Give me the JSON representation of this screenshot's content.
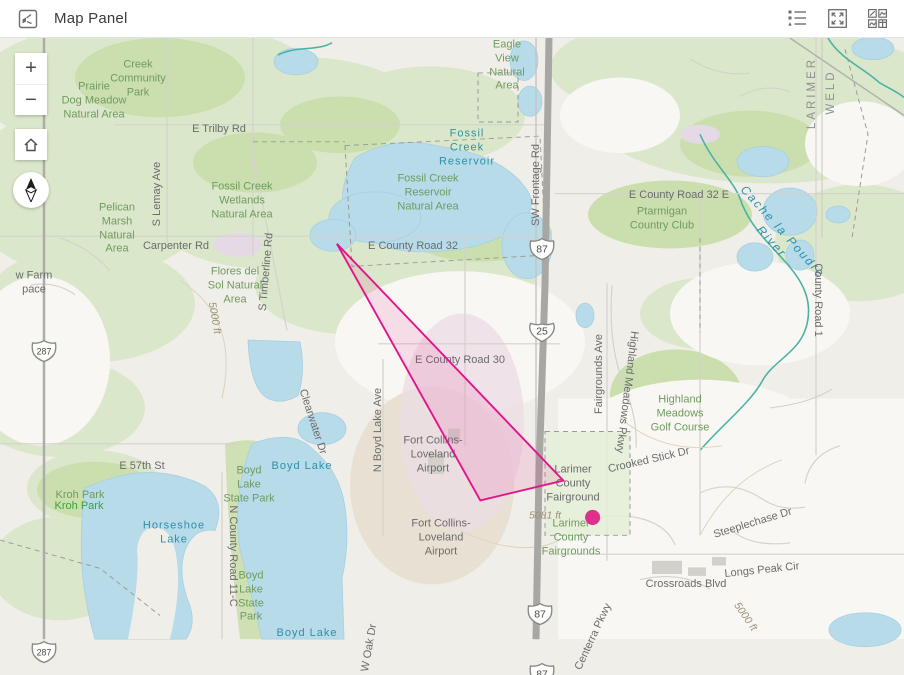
{
  "header": {
    "title": "Map Panel",
    "buttons": {
      "legend": "legend",
      "expand": "expand",
      "overview": "widget-overview"
    }
  },
  "controls": {
    "zoom_in": "+",
    "zoom_out": "−",
    "home": "home",
    "compass": "north"
  },
  "map": {
    "overlay": {
      "polygon_points": "330,256 570,507 482,528",
      "stroke": "#e2148c",
      "fill": "rgba(228,22,140,0.12)",
      "dot": {
        "x": 601,
        "y": 546,
        "r": 8,
        "color": "#dd2f8b"
      }
    },
    "shields": [
      {
        "type": "us",
        "text": "287",
        "x": 43,
        "y": 350
      },
      {
        "type": "us",
        "text": "287",
        "x": 43,
        "y": 651
      },
      {
        "type": "us",
        "text": "87",
        "x": 541,
        "y": 248
      },
      {
        "type": "interstate",
        "text": "25",
        "x": 541,
        "y": 330
      },
      {
        "type": "us",
        "text": "87",
        "x": 539,
        "y": 613
      },
      {
        "type": "us",
        "text": "87",
        "x": 541,
        "y": 673
      }
    ],
    "labels": [
      {
        "t": "Creek\nCommunity\nPark",
        "x": 138,
        "y": 79,
        "s": "green"
      },
      {
        "t": "Prairie\nDog Meadow\nNatural Area",
        "x": 94,
        "y": 101,
        "s": "green"
      },
      {
        "t": "E Trilby Rd",
        "x": 219,
        "y": 130,
        "s": "road"
      },
      {
        "t": "Eagle\nView\nNatural\nArea",
        "x": 507,
        "y": 66,
        "s": "green"
      },
      {
        "t": "Fossil\nCreek\nReservoir",
        "x": 467,
        "y": 148,
        "s": "water"
      },
      {
        "t": "Fossil Creek\nWetlands\nNatural Area",
        "x": 242,
        "y": 201,
        "s": "green"
      },
      {
        "t": "Fossil Creek\nReservoir\nNatural Area",
        "x": 428,
        "y": 193,
        "s": "green"
      },
      {
        "t": "SW Frontage Rd",
        "x": 537,
        "y": 185,
        "r": -90,
        "s": "road"
      },
      {
        "t": "E County Road 32 E",
        "x": 679,
        "y": 196,
        "s": "road"
      },
      {
        "t": "Ptarmigan\nCountry Club",
        "x": 662,
        "y": 219,
        "s": "green"
      },
      {
        "t": "Cache la Poudre River",
        "x": 777,
        "y": 237,
        "r": 48,
        "s": "witalic"
      },
      {
        "t": "County Road 1",
        "x": 817,
        "y": 300,
        "r": 90,
        "s": "road"
      },
      {
        "t": "LARIMER",
        "x": 812,
        "y": 93,
        "r": -90,
        "s": "county"
      },
      {
        "t": "WELD",
        "x": 831,
        "y": 92,
        "r": -90,
        "s": "county"
      },
      {
        "t": "Pelican\nMarsh\nNatural\nArea",
        "x": 117,
        "y": 229,
        "s": "green"
      },
      {
        "t": "S Lemay Ave",
        "x": 158,
        "y": 194,
        "r": -90,
        "s": "road"
      },
      {
        "t": "Carpenter Rd",
        "x": 176,
        "y": 247,
        "s": "road"
      },
      {
        "t": "Flores del\nSol Natural\nArea",
        "x": 235,
        "y": 286,
        "s": "green"
      },
      {
        "t": "S Timberline Rd",
        "x": 267,
        "y": 272,
        "r": -85,
        "s": "road"
      },
      {
        "t": "w Farm\npace",
        "x": 34,
        "y": 283,
        "s": "road"
      },
      {
        "t": "E County Road 32",
        "x": 413,
        "y": 247,
        "s": "road"
      },
      {
        "t": "E County Road 30",
        "x": 460,
        "y": 361,
        "s": "road"
      },
      {
        "t": "Fairgrounds Ave",
        "x": 600,
        "y": 374,
        "r": -90,
        "s": "road"
      },
      {
        "t": "Highland Meadows Pkwy",
        "x": 626,
        "y": 392,
        "r": 97,
        "s": "road"
      },
      {
        "t": "Highland\nMeadows\nGolf Course",
        "x": 680,
        "y": 414,
        "s": "green"
      },
      {
        "t": "Crooked Stick Dr",
        "x": 649,
        "y": 461,
        "r": -13,
        "s": "road"
      },
      {
        "t": "N Boyd Lake Ave",
        "x": 379,
        "y": 430,
        "r": -90,
        "s": "road"
      },
      {
        "t": "Clearwater Dr",
        "x": 312,
        "y": 422,
        "r": 72,
        "s": "road"
      },
      {
        "t": "Fort Collins-\nLoveland\nAirport",
        "x": 433,
        "y": 455,
        "s": "road"
      },
      {
        "t": "Fort Collins-\nLoveland\nAirport",
        "x": 441,
        "y": 538,
        "s": "road"
      },
      {
        "t": "Larimer\nCounty\nFairground",
        "x": 573,
        "y": 484,
        "s": "road"
      },
      {
        "t": "5081 ft",
        "x": 545,
        "y": 516,
        "s": "contour"
      },
      {
        "t": "Larimer\nCounty\nFairgrounds",
        "x": 571,
        "y": 538,
        "s": "green"
      },
      {
        "t": "Steeplechase Dr",
        "x": 753,
        "y": 524,
        "r": -17,
        "s": "road"
      },
      {
        "t": "Longs Peak Cir",
        "x": 762,
        "y": 571,
        "r": -6,
        "s": "road"
      },
      {
        "t": "Crossroads Blvd",
        "x": 686,
        "y": 585,
        "s": "road"
      },
      {
        "t": "Centerra Pkwy",
        "x": 594,
        "y": 637,
        "r": -65,
        "s": "road"
      },
      {
        "t": "E 57th St",
        "x": 142,
        "y": 467,
        "s": "road"
      },
      {
        "t": "Kroh Park",
        "x": 80,
        "y": 496,
        "s": "green"
      },
      {
        "t": "Kroh Park",
        "x": 79,
        "y": 507,
        "s": "bright"
      },
      {
        "t": "Boyd\nLake\nState Park",
        "x": 249,
        "y": 485,
        "s": "green"
      },
      {
        "t": "Boyd Lake",
        "x": 302,
        "y": 467,
        "s": "water"
      },
      {
        "t": "Horseshoe\nLake",
        "x": 174,
        "y": 533,
        "s": "water"
      },
      {
        "t": "N County Road 11-C",
        "x": 232,
        "y": 556,
        "r": 90,
        "s": "road"
      },
      {
        "t": "Boyd\nLake\nState\nPark",
        "x": 251,
        "y": 597,
        "s": "green"
      },
      {
        "t": "Boyd Lake",
        "x": 307,
        "y": 634,
        "s": "water"
      },
      {
        "t": "W Oak Dr",
        "x": 370,
        "y": 648,
        "r": -80,
        "s": "road"
      },
      {
        "t": "5000 ft",
        "x": 214,
        "y": 318,
        "r": 80,
        "s": "contour"
      },
      {
        "t": "5000 ft",
        "x": 745,
        "y": 617,
        "r": 55,
        "s": "contour"
      }
    ],
    "palette": {
      "base": "#f0eee8",
      "veg_light": "#dbe7ca",
      "veg_dark": "#cbdfae",
      "water": "#b7dbe9",
      "river": "#49b2a4",
      "road_major": "#a9a7a4",
      "road_minor": "#d6d4cf",
      "urban_white": "#f8f7f4",
      "urban_pink": "#ecdce6",
      "airport_tan": "#e8e1d3",
      "label_road": "#6b6b6b",
      "label_area": "#6f9b5f",
      "label_water": "#2f90a8",
      "overlay_magenta": "#e2148c"
    }
  }
}
